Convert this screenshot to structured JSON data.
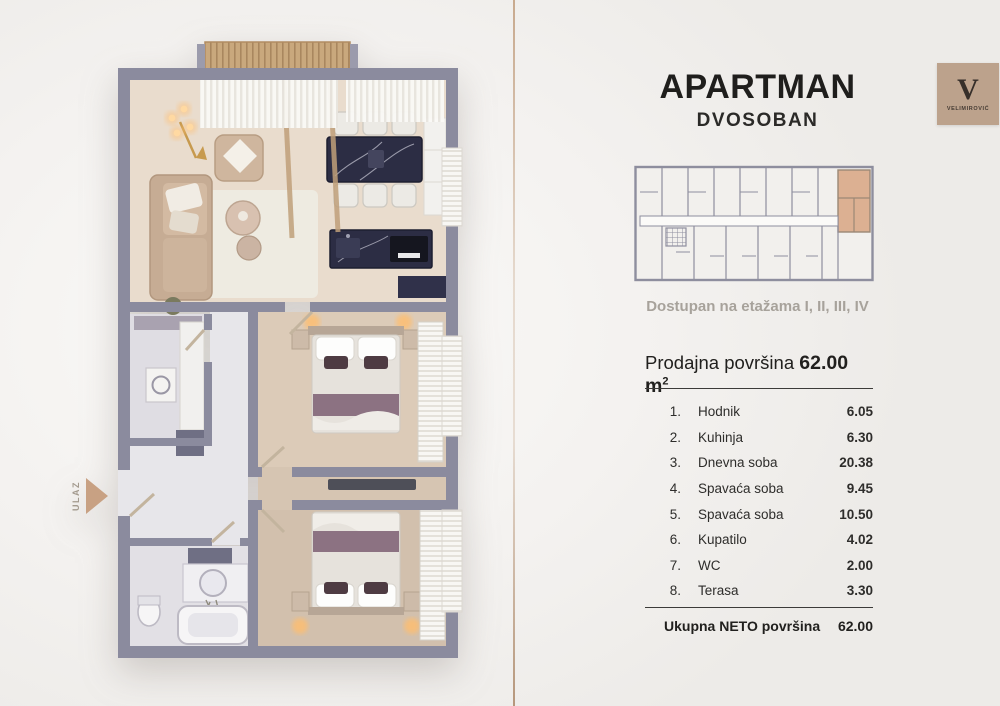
{
  "header": {
    "title": "APARTMAN",
    "subtitle": "DVOSOBAN"
  },
  "logo": {
    "monogram": "V",
    "brand": "VELIMIROVIĆ"
  },
  "availability": "Dostupan na etažama I, II, III, IV",
  "sale_area": {
    "label": "Prodajna površina",
    "value": "62.00",
    "unit": "m",
    "unit_sup": "2"
  },
  "rooms": [
    {
      "num": "1.",
      "name": "Hodnik",
      "area": "6.05"
    },
    {
      "num": "2.",
      "name": "Kuhinja",
      "area": "6.30"
    },
    {
      "num": "3.",
      "name": "Dnevna soba",
      "area": "20.38"
    },
    {
      "num": "4.",
      "name": "Spavaća soba",
      "area": "9.45"
    },
    {
      "num": "5.",
      "name": "Spavaća soba",
      "area": "10.50"
    },
    {
      "num": "6.",
      "name": "Kupatilo",
      "area": "4.02"
    },
    {
      "num": "7.",
      "name": "WC",
      "area": "2.00"
    },
    {
      "num": "8.",
      "name": "Terasa",
      "area": "3.30"
    }
  ],
  "total": {
    "label": "Ukupna NETO površina",
    "value": "62.00"
  },
  "entrance_label": "ULAZ",
  "colors": {
    "wall": "#8b8b9e",
    "wood_floor": "#e9dccd",
    "marble_dark": "#2c2d44",
    "sofa_beige": "#c6ac94",
    "bed_accent": "#8c7282",
    "highlight_unit": "#dcb092",
    "accent_tan": "#c8a183",
    "divider_tan": "#c6a689",
    "warm_glow": "#ffbe6e"
  }
}
